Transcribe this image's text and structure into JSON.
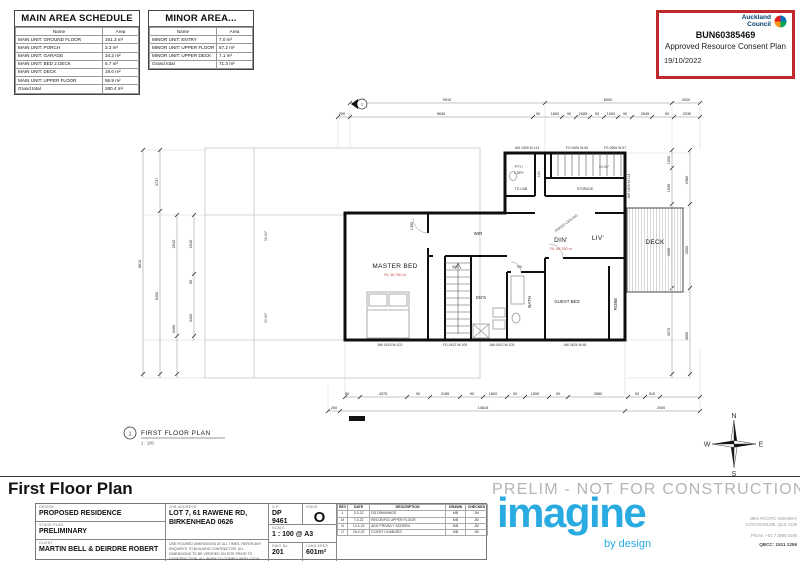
{
  "sheet": {
    "page_title": "First Floor Plan"
  },
  "schedules": {
    "main": {
      "title": "MAIN AREA SCHEDULE",
      "col_name": "Name",
      "col_area": "Area",
      "rows": [
        {
          "name": "MAIN UNIT: GROUND FLOOR",
          "area": "161.3 m²"
        },
        {
          "name": "MAIN UNIT: PORCH",
          "area": "3.3 m²"
        },
        {
          "name": "MAIN UNIT: GARAGE",
          "area": "34.2 m²"
        },
        {
          "name": "MAIN UNIT: BED 2 DECK",
          "area": "5.7 m²"
        },
        {
          "name": "MAIN UNIT: DECK",
          "area": "19.0 m²"
        },
        {
          "name": "MAIN UNIT: UPPER FLOOR",
          "area": "56.9 m²"
        }
      ],
      "total_label": "Grand total",
      "total": "280.4 m²"
    },
    "minor": {
      "title": "MINOR AREA...",
      "col_name": "Name",
      "col_area": "Area",
      "rows": [
        {
          "name": "MINOR UNIT: ENTRY",
          "area": "7.0 m²"
        },
        {
          "name": "MINOR UNIT: UPPER FLOOR",
          "area": "57.2 m²"
        },
        {
          "name": "MINOR UNIT: UPPER DECK",
          "area": "7.1 m²"
        }
      ],
      "total_label": "Grand total",
      "total": "71.3 m²"
    }
  },
  "stamp": {
    "org_line1": "Auckland",
    "org_line2": "Council",
    "ref": "BUN60385469",
    "approval": "Approved Resource Consent Plan",
    "date": "19/10/2022"
  },
  "plan": {
    "caption": {
      "num": "1",
      "title": "FIRST FLOOR PLAN",
      "scale": "1 : 100"
    },
    "rooms": {
      "master": "MASTER BED",
      "wir": "WIR",
      "ens": "EN'S",
      "bath": "BATH",
      "guest": "GUEST BED",
      "robe": "ROBE",
      "din": "DIN'",
      "liv": "LIV'",
      "deck": "DECK",
      "pty1": "PTY /",
      "pty2": "L'DRY",
      "lin": "LIN",
      "storage": "STORAGE",
      "tdcab": "TD CAB"
    },
    "levels": {
      "master_rl": "RL 46.780 m",
      "din_rl": "RL 46.780 m"
    },
    "notes": {
      "raked": "RAKED CEILING",
      "angle": "30.00°",
      "bearing1": "30.00°",
      "bearing2": "30.00°"
    },
    "windows": [
      "AW 1806 W-113",
      "FG 0606 W-56",
      "FG-0606 W-57",
      "AW 1806 W-114",
      "AW 0418 W-102",
      "FG-0412 W-109",
      "AW-0412 W-103",
      "AW 0624 W-65"
    ],
    "dims": {
      "top1": [
        "9910",
        "6000",
        "2020"
      ],
      "top2": [
        "200",
        "9630",
        "90",
        "1800",
        "90",
        "2085",
        "90",
        "1000",
        "90",
        "2545",
        "90",
        "2030"
      ],
      "bottom1": [
        "90",
        "4375",
        "90",
        "2185",
        "90",
        "1800",
        "90",
        "1550",
        "90",
        "3580",
        "90",
        "510"
      ],
      "bottom2": [
        "200",
        "14615",
        "2000"
      ],
      "left": [
        "6610",
        "3737",
        "6400",
        "2940",
        "3400",
        "2940",
        "90",
        "3400"
      ],
      "right_inner": [
        "1000",
        "1935",
        "4490",
        "3370"
      ],
      "right_outer": [
        "2980",
        "2500",
        "3650"
      ],
      "interior": [
        "1300",
        "600",
        "700"
      ]
    }
  },
  "compass": {
    "n": "N",
    "e": "E",
    "s": "S",
    "w": "W"
  },
  "titleblock": {
    "design_label": "DESIGN",
    "design": "PROPOSED RESIDENCE",
    "stage_label": "STAGE PLAN",
    "stage": "PRELIMINARY",
    "client_label": "CLIENT",
    "client": "MARTIN BELL & DEIRDRE ROBERT",
    "job_label": "JOB ADDRESS",
    "job_line1": "LOT 7, 61 RAWENE RD,",
    "job_line2": "BIRKENHEAD 0626",
    "disclaimer": "USE FIGURED DIMENSIONS AT ALL TIMES. REFER ANY ENQUIRYS TO BUILDING CONTRACTOR. ALL DIMENSIONS TO BE VERIFIED ON SITE PRIOR TO CONSTRUCTION. ALL WORK TO COMPLY WITH LOCAL AUTHORITY REGULATIONS.",
    "sp_label": "S.P",
    "sp": "DP 9461",
    "issue_label": "ISSUE",
    "issue": "O",
    "scale_label": "SCALE",
    "scale": "1 : 100 @ A3",
    "dwg_label": "DWG No.",
    "dwg": "201",
    "land_label": "LAND AREA",
    "land": "601m²",
    "rev_headers": [
      "REV",
      "DATE",
      "DESCRIPTION",
      "DRAWN",
      "CHECKED"
    ],
    "revs": [
      [
        "L",
        "3.3.22",
        "DD DRAWINGS",
        "MB",
        "JM"
      ],
      [
        "M",
        "7.4.22",
        "RECONFIG UPPER FLOOR",
        "MB",
        "JM"
      ],
      [
        "N",
        "14.4.22",
        "ADD PRIVACY SCREEN",
        "MB",
        "JM"
      ],
      [
        "O",
        "26.4.22",
        "CLIENT CHANGES",
        "MB",
        "JM"
      ]
    ]
  },
  "branding": {
    "prelim": "PRELIM - NOT FOR CONSTRUCTION",
    "logo": "imagine",
    "tagline": "by design",
    "addr1": "2964 PACIFIC HIGHWAY",
    "addr2": "LOGANHOLME, QLD 4129",
    "phone": "Phone: +61 7 3806 0195",
    "qbcc": "QBCC: 1511 1256"
  },
  "colors": {
    "stamp_red": "#c0272d",
    "council_blue": "#003e6b",
    "brand_blue": "#29abe2",
    "prelim_gray": "#b5b5b5",
    "rl_red": "#c0504d"
  }
}
